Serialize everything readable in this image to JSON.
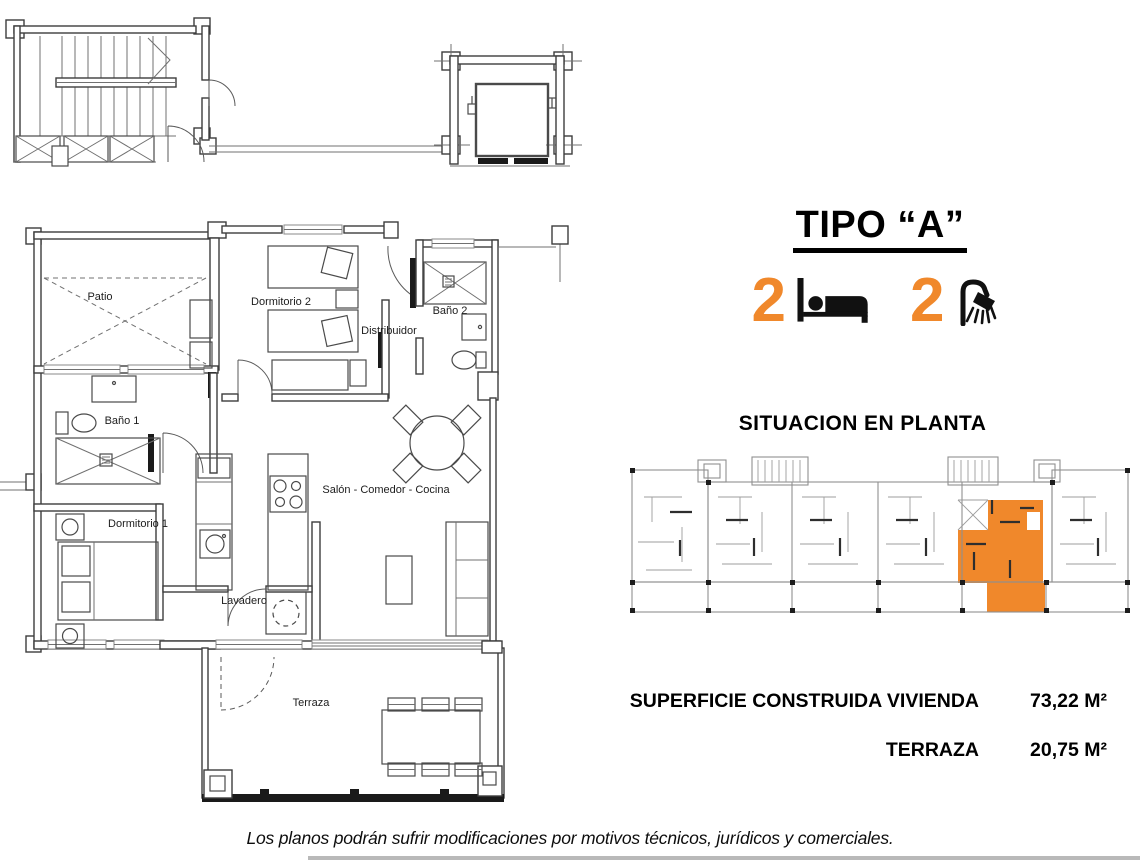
{
  "title": "TIPO “A”",
  "features": {
    "bedrooms": {
      "count": "2"
    },
    "bathrooms": {
      "count": "2"
    }
  },
  "situation_heading": "SITUACION EN PLANTA",
  "surfaces": [
    {
      "label": "SUPERFICIE CONSTRUIDA VIVIENDA",
      "value": "73,22 M²"
    },
    {
      "label": "TERRAZA",
      "value": "20,75 M²"
    }
  ],
  "disclaimer": "Los planos podrán sufrir modificaciones por motivos técnicos, jurídicos y comerciales.",
  "floorplan": {
    "labels": {
      "patio": "Patio",
      "dormitorio2": "Dormitorio 2",
      "bano2": "Baño 2",
      "distribuidor": "Distribuidor",
      "bano1": "Baño 1",
      "dormitorio1": "Dormitorio 1",
      "salon": "Salón - Comedor - Cocina",
      "lavadero": "Lavadero",
      "terraza": "Terraza"
    }
  },
  "colors": {
    "accent_orange": "#F0882B",
    "plan_line": "#3d3d3d",
    "situation_line": "#8f8f8f"
  }
}
